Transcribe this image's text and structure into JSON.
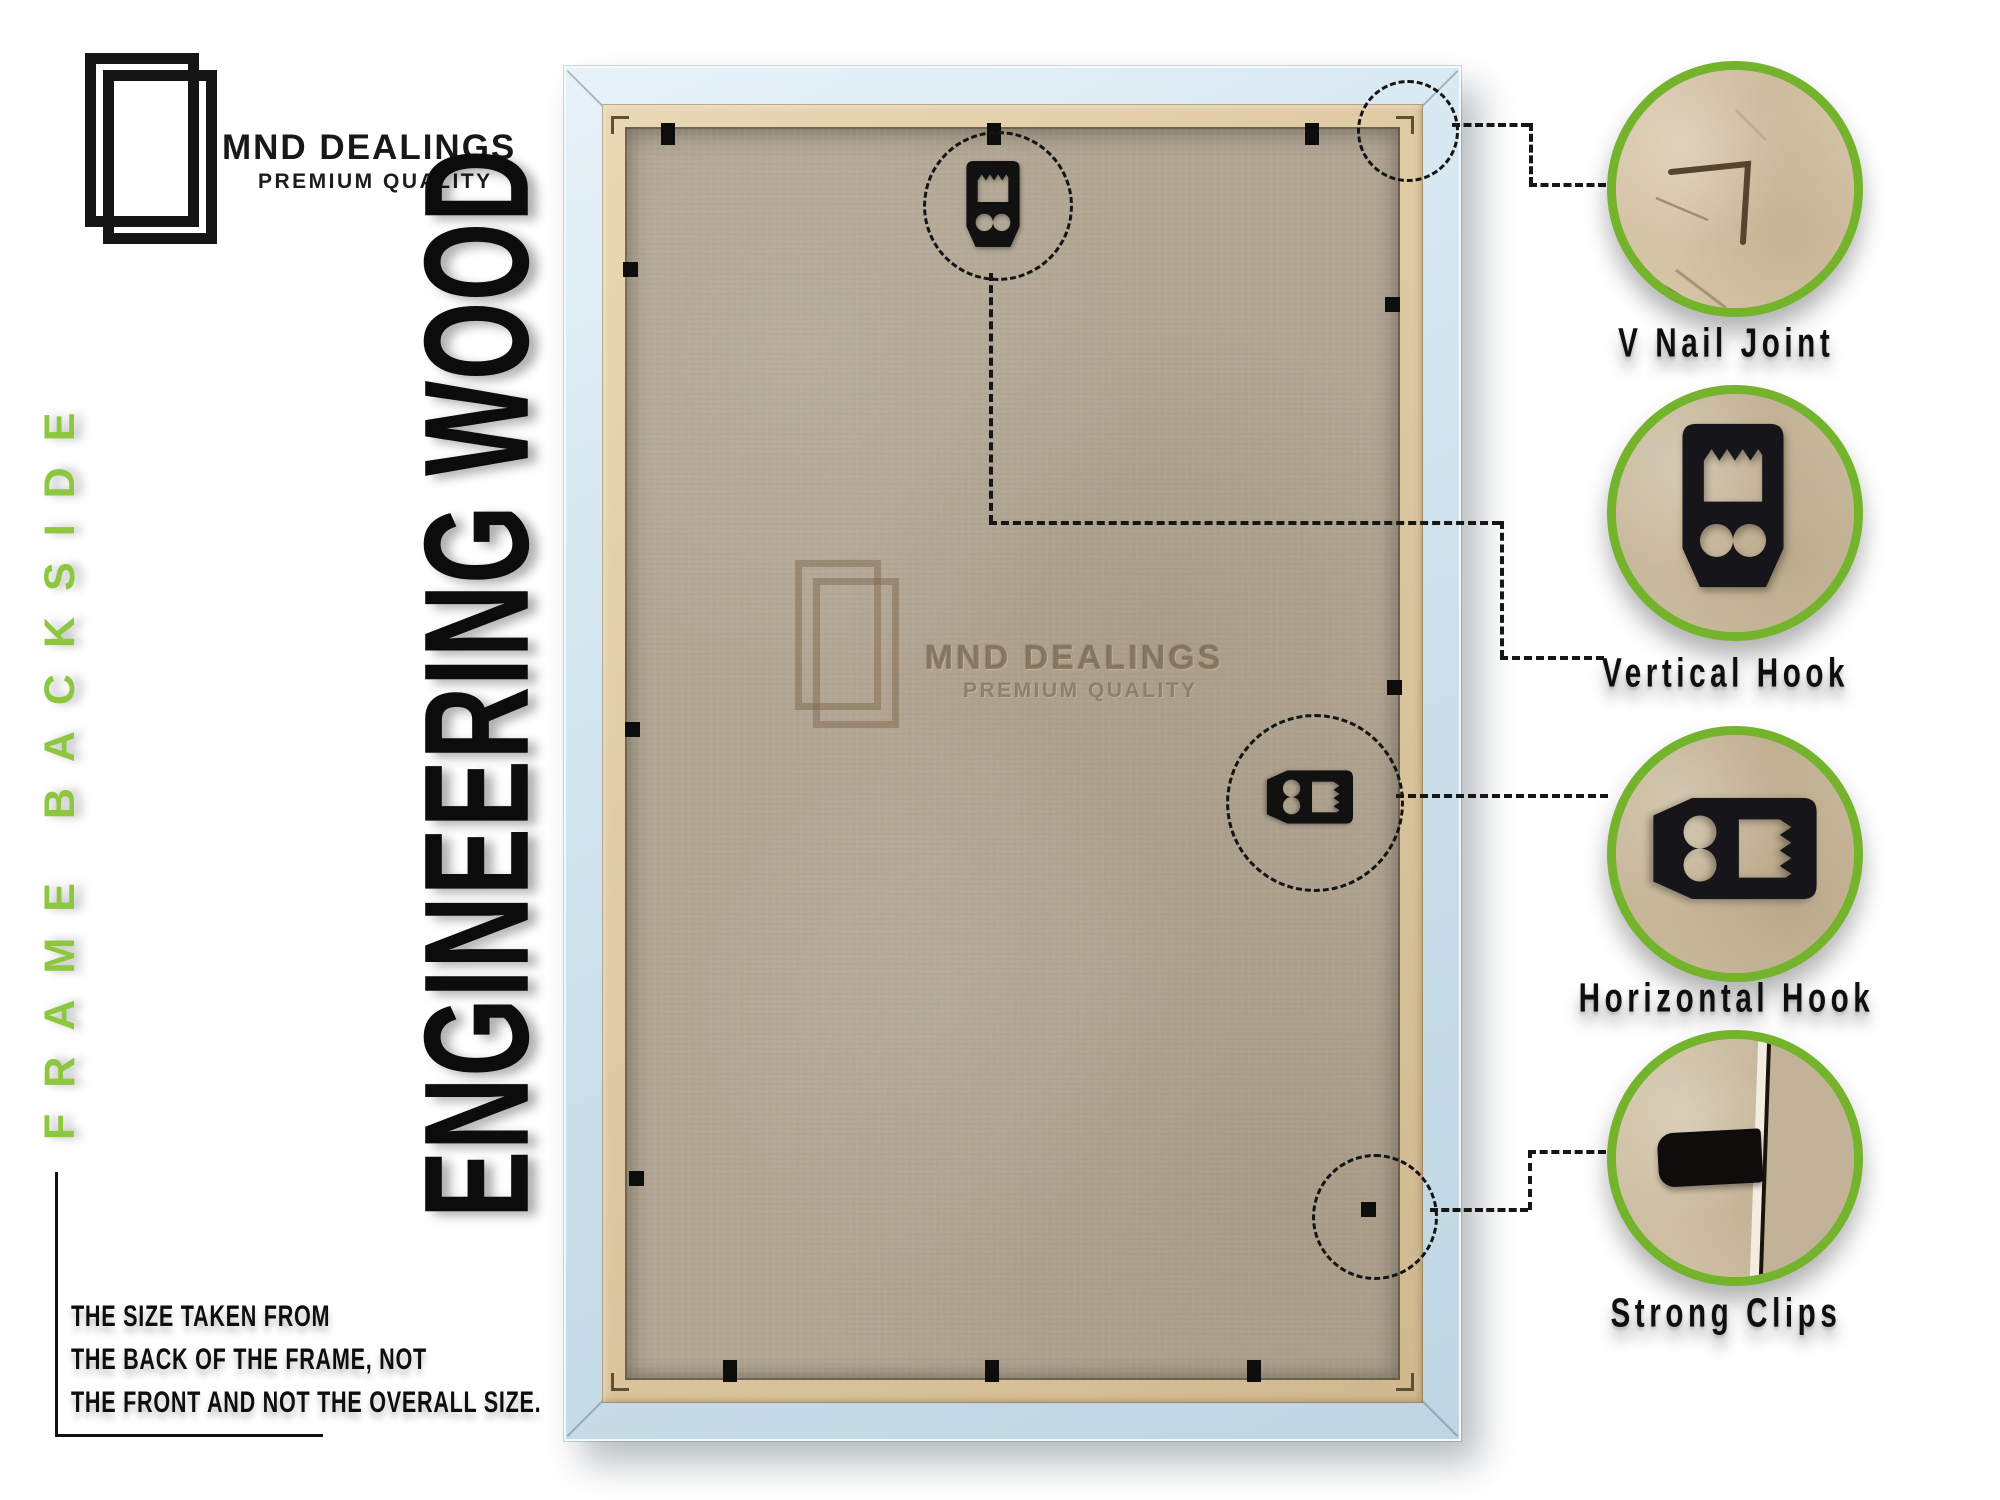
{
  "brand": {
    "logo_icon": "overlapping-frames-icon",
    "title": "MND DEALINGS",
    "tagline": "PREMIUM QUALITY"
  },
  "side_label": {
    "text": "FRAME BACKSIDE"
  },
  "main_title": {
    "text": "ENGINEERING WOOD"
  },
  "frame_photo": {
    "watermark": {
      "icon": "overlapping-frames-icon",
      "title": "MND DEALINGS",
      "tagline": "PREMIUM QUALITY"
    }
  },
  "callouts": [
    {
      "label": "V Nail Joint",
      "photo": "v-nail-joint-closeup"
    },
    {
      "label": "Vertical Hook",
      "photo": "vertical-hook-closeup"
    },
    {
      "label": "Horizontal Hook",
      "photo": "horizontal-hook-closeup"
    },
    {
      "label": "Strong Clips",
      "photo": "strong-clip-closeup"
    }
  ],
  "note": {
    "lines": [
      "THE SIZE TAKEN FROM",
      "THE BACK OF THE FRAME, NOT",
      "THE FRONT AND NOT THE OVERALL SIZE."
    ]
  },
  "colors": {
    "accent_green": "#8dc63f",
    "ring_green": "#74b42c",
    "ink": "#121212",
    "frame_blue": "#cfe2ec",
    "wood_tan": "#ddc9a3",
    "board_tan": "#b2a693",
    "kraft": "#cbbb9e"
  }
}
